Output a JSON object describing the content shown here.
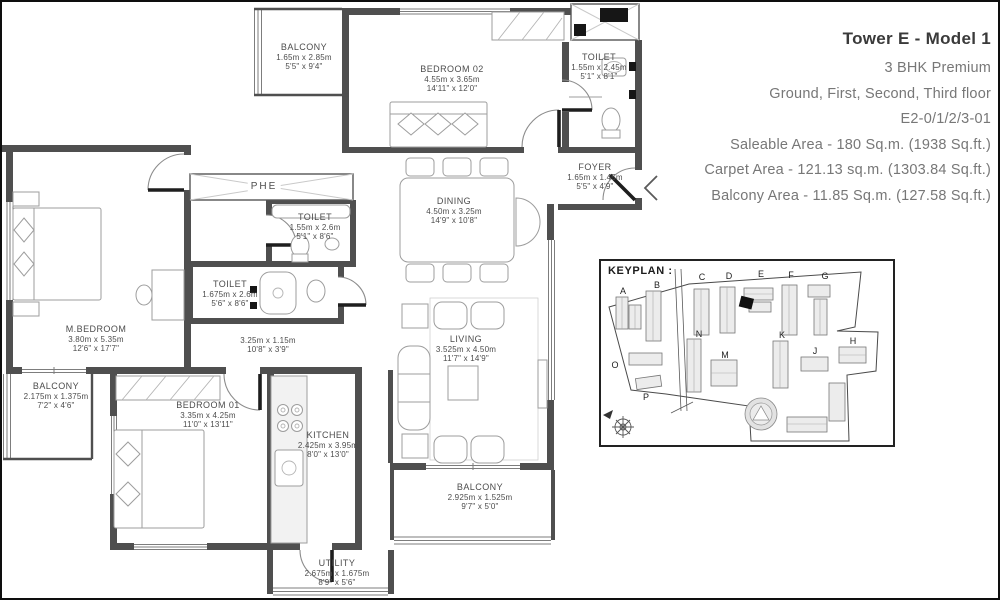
{
  "colors": {
    "wall": "#4f4f4f",
    "furniture_line": "#9d9d9d",
    "label_text": "#4c4c4c",
    "title_text": "#3a3a3a",
    "muted_text": "#777777"
  },
  "title_block": {
    "title": "Tower E - Model 1",
    "type": "3 BHK Premium",
    "floors": "Ground, First, Second, Third floor",
    "unit_code": "E2-0/1/2/3-01",
    "saleable": "Saleable Area - 180 Sq.m. (1938 Sq.ft.)",
    "carpet": "Carpet Area - 121.13 sq.m. (1303.84 Sq.ft.)",
    "balcony": "Balcony Area - 11.85 Sq.m. (127.58 Sq.ft.)"
  },
  "labels": {
    "phe": "PHE",
    "keyplan": "KEYPLAN :"
  },
  "rooms": {
    "balcony_top": {
      "name": "BALCONY",
      "dim_m": "1.65m x 2.85m",
      "dim_ft": "5'5\" x 9'4\""
    },
    "bedroom02": {
      "name": "BEDROOM 02",
      "dim_m": "4.55m x 3.65m",
      "dim_ft": "14'11\" x 12'0\""
    },
    "toilet_top": {
      "name": "TOILET",
      "dim_m": "1.55m x 2.45m",
      "dim_ft": "5'1\" x 8'1\""
    },
    "foyer": {
      "name": "FOYER",
      "dim_m": "1.65m x 1.45m",
      "dim_ft": "5'5\" x 4'9\""
    },
    "dining": {
      "name": "DINING",
      "dim_m": "4.50m x 3.25m",
      "dim_ft": "14'9\" x 10'8\""
    },
    "toilet_mid": {
      "name": "TOILET",
      "dim_m": "1.55m x 2.6m",
      "dim_ft": "5'1\" x 8'6\""
    },
    "toilet_master": {
      "name": "TOILET",
      "dim_m": "1.675m x 2.6m",
      "dim_ft": "5'6\" x 8'6\""
    },
    "m_bedroom": {
      "name": "M.BEDROOM",
      "dim_m": "3.80m x 5.35m",
      "dim_ft": "12'6\" x 17'7\""
    },
    "passage": {
      "name": "",
      "dim_m": "3.25m x 1.15m",
      "dim_ft": "10'8\" x 3'9\""
    },
    "balcony_left": {
      "name": "BALCONY",
      "dim_m": "2.175m x 1.375m",
      "dim_ft": "7'2\" x 4'6\""
    },
    "bedroom01": {
      "name": "BEDROOM 01",
      "dim_m": "3.35m x 4.25m",
      "dim_ft": "11'0\" x 13'11\""
    },
    "kitchen": {
      "name": "KITCHEN",
      "dim_m": "2.425m x 3.95m",
      "dim_ft": "8'0\" x 13'0\""
    },
    "living": {
      "name": "LIVING",
      "dim_m": "3.525m x 4.50m",
      "dim_ft": "11'7\" x 14'9\""
    },
    "balcony_bottom": {
      "name": "BALCONY",
      "dim_m": "2.925m x 1.525m",
      "dim_ft": "9'7\" x 5'0\""
    },
    "utility": {
      "name": "UTILITY",
      "dim_m": "2.675m x 1.675m",
      "dim_ft": "8'9\" x 5'6\""
    }
  },
  "keyplan": {
    "towers": [
      {
        "label": "A"
      },
      {
        "label": "B"
      },
      {
        "label": "C"
      },
      {
        "label": "D"
      },
      {
        "label": "E"
      },
      {
        "label": "F"
      },
      {
        "label": "G"
      },
      {
        "label": "H"
      },
      {
        "label": "J"
      },
      {
        "label": "K"
      },
      {
        "label": "M"
      },
      {
        "label": "N"
      },
      {
        "label": "O"
      },
      {
        "label": "P"
      }
    ],
    "highlighted_tower": "E"
  }
}
